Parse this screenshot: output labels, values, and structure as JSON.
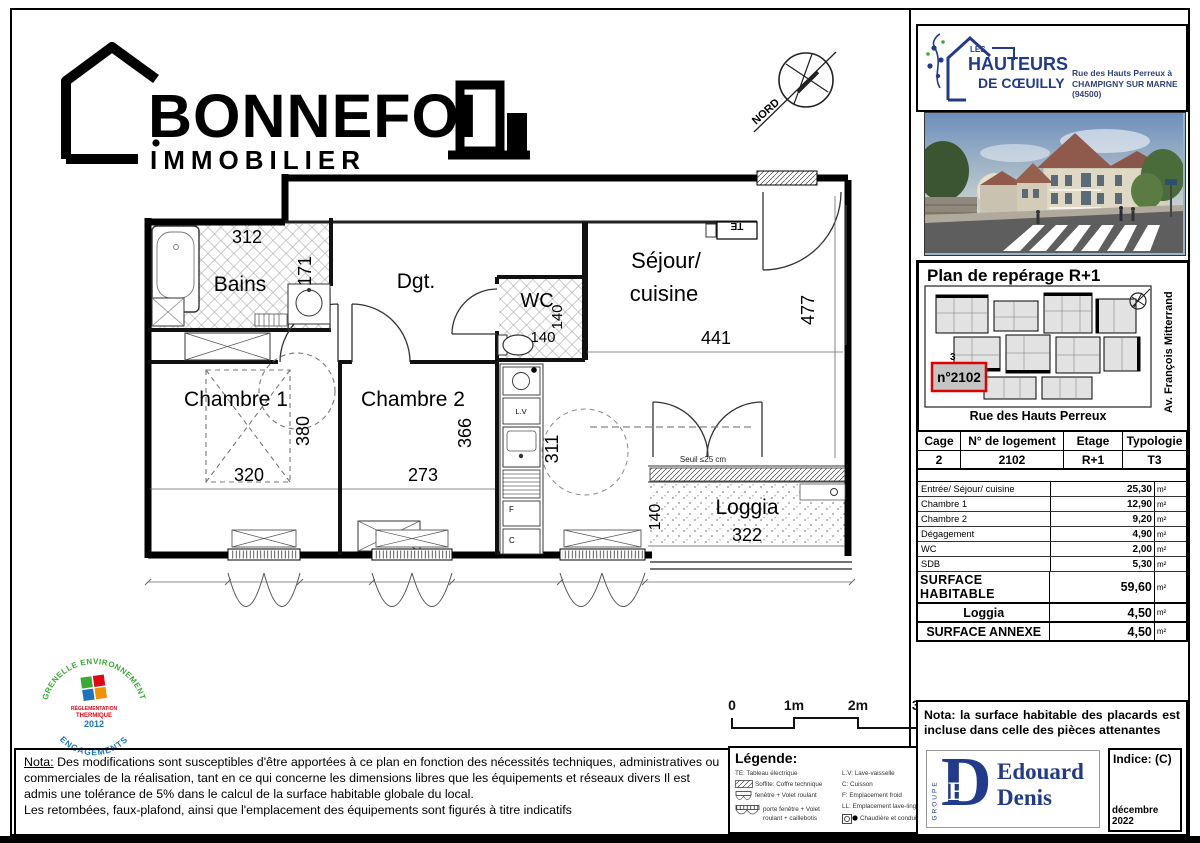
{
  "brand": {
    "name": "BONNEFOI",
    "subtitle": "IMMOBILIER"
  },
  "compass": {
    "label": "NORD"
  },
  "project": {
    "les": "LES",
    "name": "HAUTEURS",
    "sub": "DE CŒUILLY",
    "address1": "Rue des Hauts Perreux à",
    "address2": "CHAMPIGNY SUR MARNE (94500)"
  },
  "reperage": {
    "title": "Plan de repérage R+1",
    "unit": "n°2102",
    "cage": "3",
    "street_bottom": "Rue des Hauts Perreux",
    "street_right": "Av. François Mitterrand"
  },
  "unit_table": {
    "headers": [
      "Cage",
      "N° de logement",
      "Etage",
      "Typologie"
    ],
    "values": [
      "2",
      "2102",
      "R+1",
      "T3"
    ],
    "rooms": [
      {
        "label": "Entrée/ Séjour/ cuisine",
        "value": "25,30",
        "unit": "m²"
      },
      {
        "label": "Chambre 1",
        "value": "12,90",
        "unit": "m²"
      },
      {
        "label": "Chambre 2",
        "value": "9,20",
        "unit": "m²"
      },
      {
        "label": "Dégagement",
        "value": "4,90",
        "unit": "m²"
      },
      {
        "label": "WC",
        "value": "2,00",
        "unit": "m²"
      },
      {
        "label": "SDB",
        "value": "5,30",
        "unit": "m²"
      }
    ],
    "surface_habitable": {
      "label": "SURFACE HABITABLE",
      "value": "59,60",
      "unit": "m²"
    },
    "loggia": {
      "label": "Loggia",
      "value": "4,50",
      "unit": "m²"
    },
    "surface_annexe": {
      "label": "SURFACE ANNEXE",
      "value": "4,50",
      "unit": "m²"
    }
  },
  "plan": {
    "labels": {
      "bains": "Bains",
      "dgt": "Dgt.",
      "wc": "WC",
      "sejour1": "Séjour/",
      "sejour2": "cuisine",
      "chambre1": "Chambre 1",
      "chambre2": "Chambre 2",
      "loggia": "Loggia"
    },
    "dims": {
      "bains_w": "312",
      "bains_h": "171",
      "wc_w": "140",
      "wc_h": "140",
      "sejour_w": "441",
      "sejour_h": "477",
      "ch1_w": "320",
      "ch1_h": "380",
      "ch2_w": "273",
      "ch2_h": "366",
      "kitchen_h": "311",
      "loggia_w": "322",
      "loggia_h": "140"
    },
    "annotations": {
      "te": "TE",
      "lv": "L.V",
      "f": "F",
      "c": "C",
      "seuil": "Seuil ≤25 cm"
    }
  },
  "scalebar": {
    "t0": "0",
    "t1": "1m",
    "t2": "2m",
    "t3": "3m"
  },
  "legend": {
    "title": "Légende:",
    "left": [
      {
        "label": "TE: Tableau électrique"
      },
      {
        "label": "Soffite: Coffre technique"
      },
      {
        "label": "fenêtre + Volet roulant"
      },
      {
        "label": "porte fenêtre + Volet roulant + caillebotis"
      }
    ],
    "right": [
      {
        "label": "L.V: Lave-vaisselle"
      },
      {
        "label": "C: Cuisson"
      },
      {
        "label": "F: Emplacement froid"
      },
      {
        "label": "LL: Emplacement lave-linge"
      },
      {
        "label": "Chaudière et conduit"
      }
    ]
  },
  "grenelle": {
    "arc_top": "GRENELLE  ENVIRONNEMENT",
    "arc_bottom": "ENGAGEMENTS",
    "line1": "RÉGLEMENTATION",
    "line2": "THERMIQUE",
    "year": "2012"
  },
  "nota_left": {
    "label": "Nota:",
    "text": "Des modifications sont susceptibles d'être apportées à ce plan en fonction des nécessités techniques, administratives ou commerciales de la réalisation, tant en ce qui concerne les dimensions libres que les équipements et réseaux divers  Il est admis une tolérance de 5% dans le calcul de la surface habitable globale du local.",
    "text2": "Les retombées, faux-plafond, ainsi que l'emplacement des équipements sont figurés à titre indicatifs"
  },
  "nota_right": {
    "label": "Nota:",
    "text": "la surface habitable des placards est incluse dans celle des pièces attenantes"
  },
  "publisher": {
    "groupe": "GROUPE",
    "d": "D",
    "e": "E",
    "name1": "Edouard",
    "name2": "Denis"
  },
  "stamp": {
    "indice": "Indice: (C)",
    "date": "décembre 2022"
  },
  "colors": {
    "navy": "#223a8c",
    "highlight_red": "#dd1111",
    "green": "#3aaa35",
    "blue": "#1b75bc",
    "orange": "#f39200",
    "logo_red": "#e30613"
  }
}
